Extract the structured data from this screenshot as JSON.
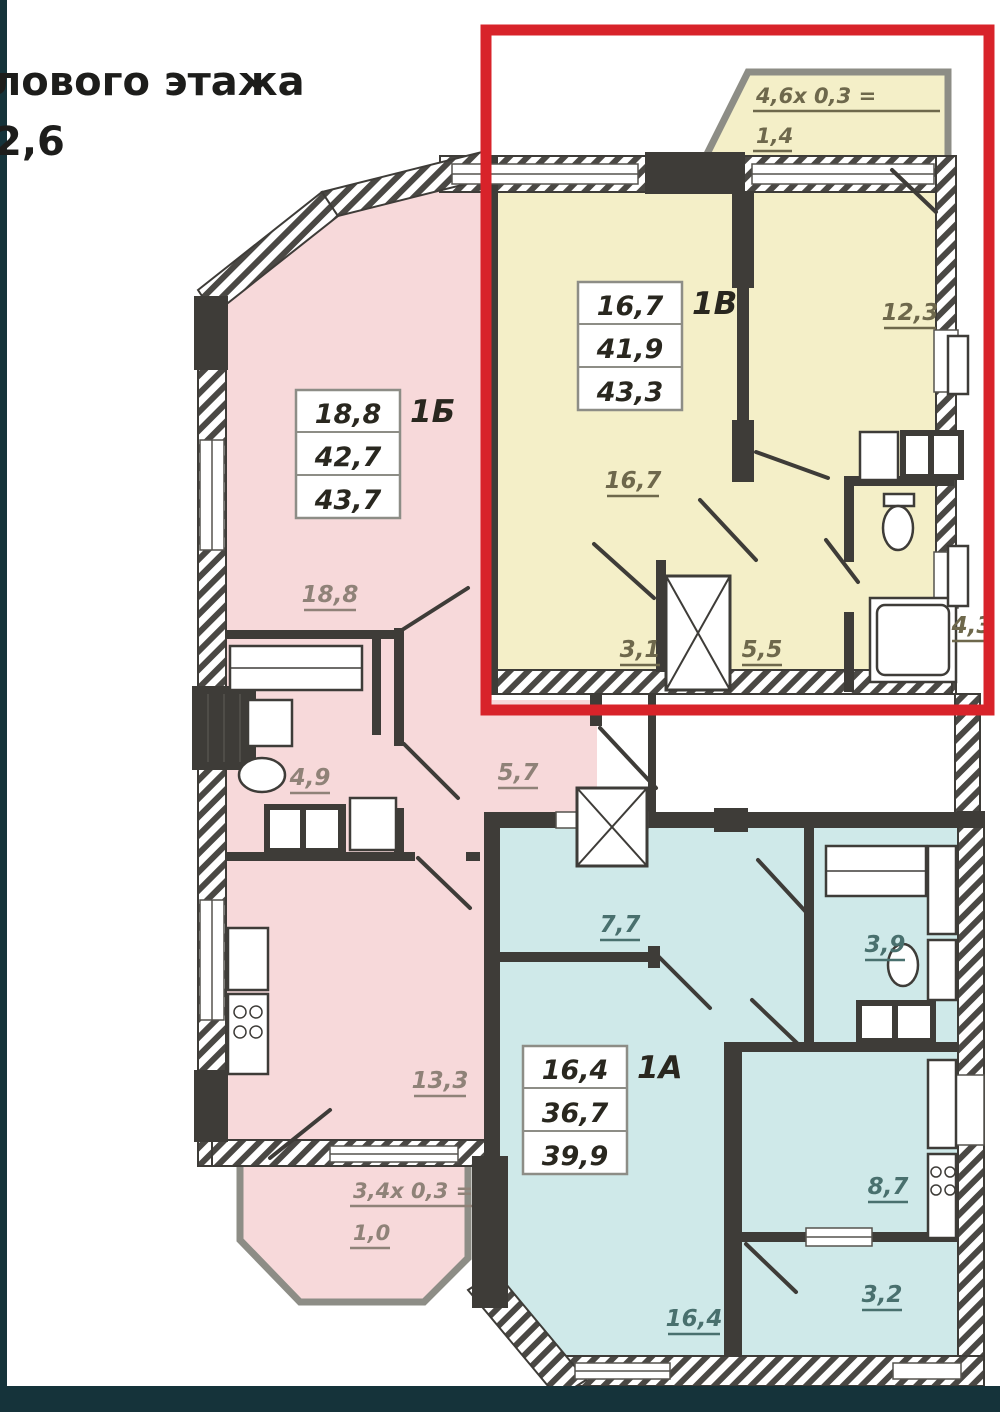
{
  "frame": {
    "color": "#15333a",
    "title_line1": "лового этажа",
    "title_line2": "2,6"
  },
  "plan": {
    "highlight_color": "#d8232a",
    "wall_color": "#3e3c38",
    "icons": {
      "bathtub": "rect-outline",
      "toilet": "ellipse",
      "sink": "ellipse",
      "washing-machine": "dark-square",
      "stove": "burner-circles",
      "elevator": "dark-block"
    },
    "apartments": {
      "b1v": {
        "type_label": "1В",
        "fill": "#f4efc8",
        "stats": [
          "16,7",
          "41,9",
          "43,3"
        ],
        "rooms": {
          "living": "16,7",
          "bedroom": "12,3",
          "hall_left": "3,1",
          "hall_right": "5,5",
          "bath": "4,3"
        },
        "balcony": {
          "formula": "4,6х 0,3 =",
          "area": "1,4"
        }
      },
      "b1b": {
        "type_label": "1Б",
        "fill": "#f7d9da",
        "stats": [
          "18,8",
          "42,7",
          "43,7"
        ],
        "rooms": {
          "living": "18,8",
          "bath": "4,9",
          "corridor": "5,7",
          "kitchen": "13,3"
        },
        "balcony": {
          "formula": "3,4х 0,3 =",
          "area": "1,0"
        }
      },
      "b1a": {
        "type_label": "1А",
        "fill": "#cfe9e9",
        "stats": [
          "16,4",
          "36,7",
          "39,9"
        ],
        "rooms": {
          "hall": "7,7",
          "bath": "3,9",
          "kitchen": "8,7",
          "living": "16,4",
          "loggia": "3,2"
        }
      }
    }
  }
}
